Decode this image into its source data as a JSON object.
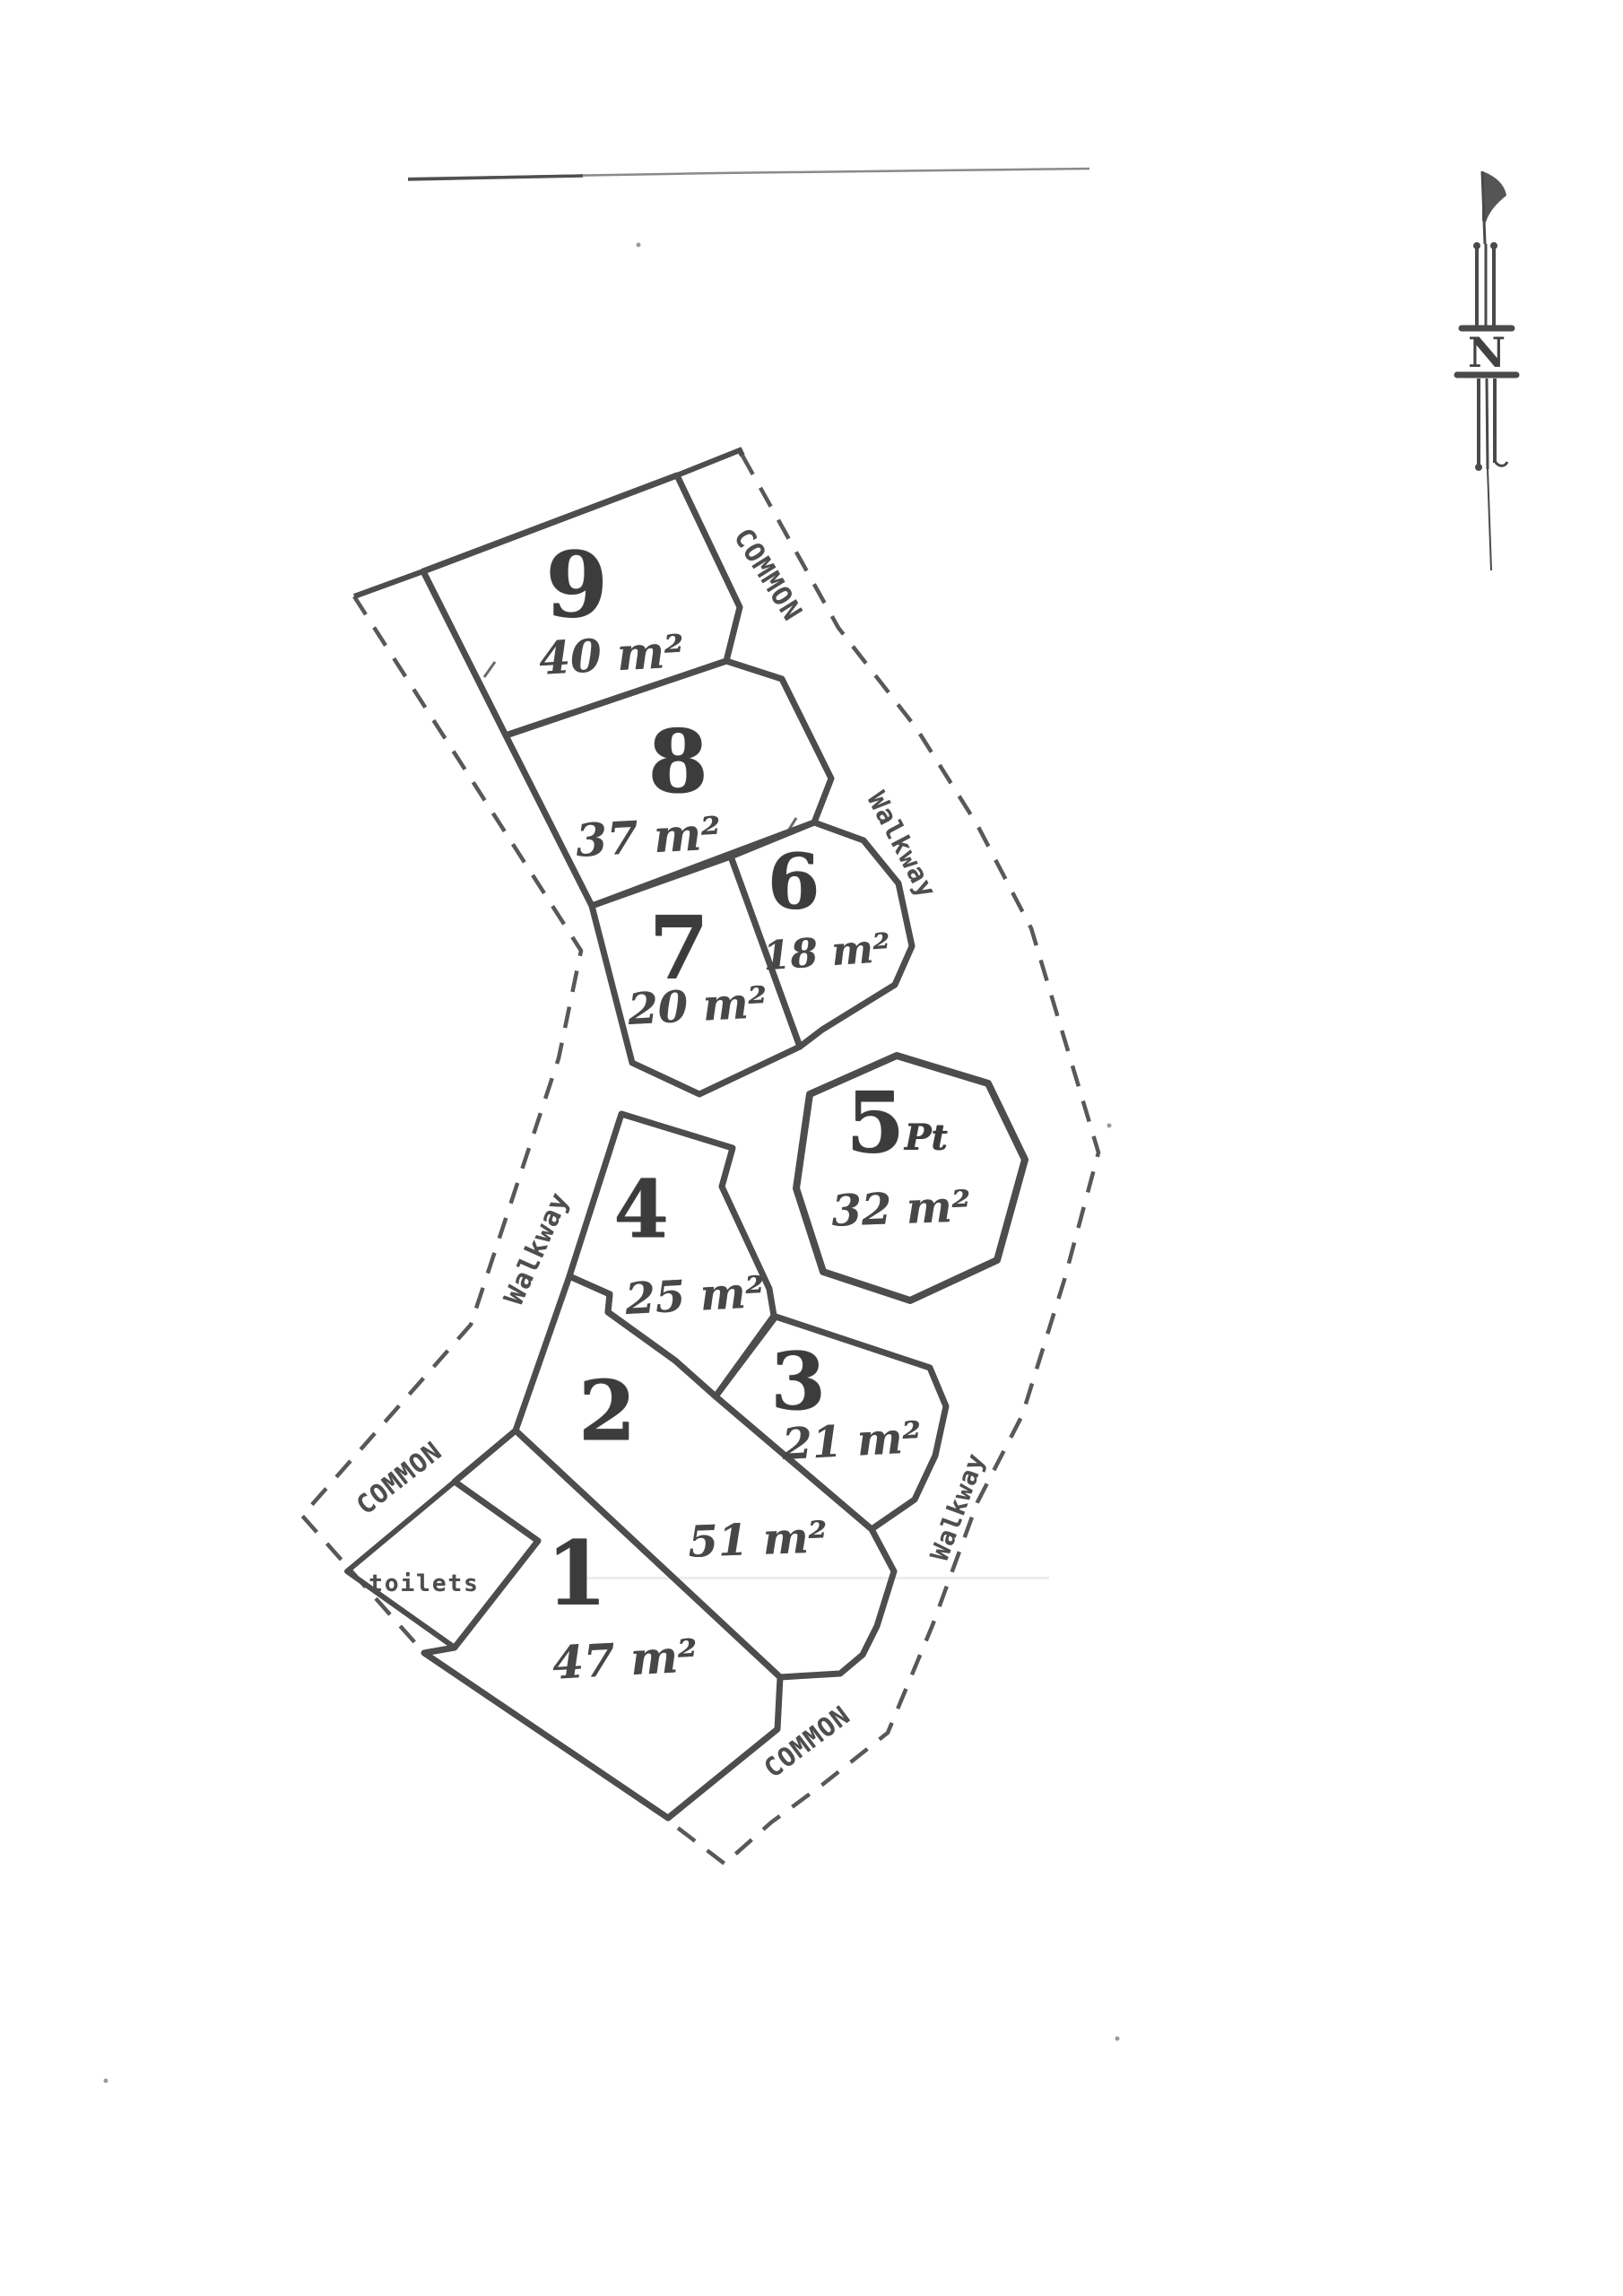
{
  "page": {
    "paper_color": "#ffffff",
    "ink_color": "#4a4a4a"
  },
  "north_arrow": {
    "label": "N"
  },
  "plan": {
    "lots": [
      {
        "number": "9",
        "area_label": "40 m²",
        "area_m2": 40
      },
      {
        "number": "8",
        "area_label": "37 m²",
        "area_m2": 37
      },
      {
        "number": "7",
        "area_label": "20 m²",
        "area_m2": 20
      },
      {
        "number": "6",
        "area_label": "18 m²",
        "area_m2": 18
      },
      {
        "number": "5",
        "suffix": "Pt",
        "area_label": "32 m²",
        "area_m2": 32
      },
      {
        "number": "4",
        "area_label": "25 m²",
        "area_m2": 25
      },
      {
        "number": "3",
        "area_label": "21 m²",
        "area_m2": 21
      },
      {
        "number": "2",
        "area_label": "51 m²",
        "area_m2": 51
      },
      {
        "number": "1",
        "area_label": "47 m²",
        "area_m2": 47
      }
    ],
    "strip_labels": {
      "common_top": "COMMON",
      "walkway_upper_right": "Walkway",
      "walkway_left": "Walkway",
      "walkway_lower_right": "Walkway",
      "common_left": "COMMON",
      "common_bottom": "COMMON",
      "toilets": "toilets"
    }
  }
}
